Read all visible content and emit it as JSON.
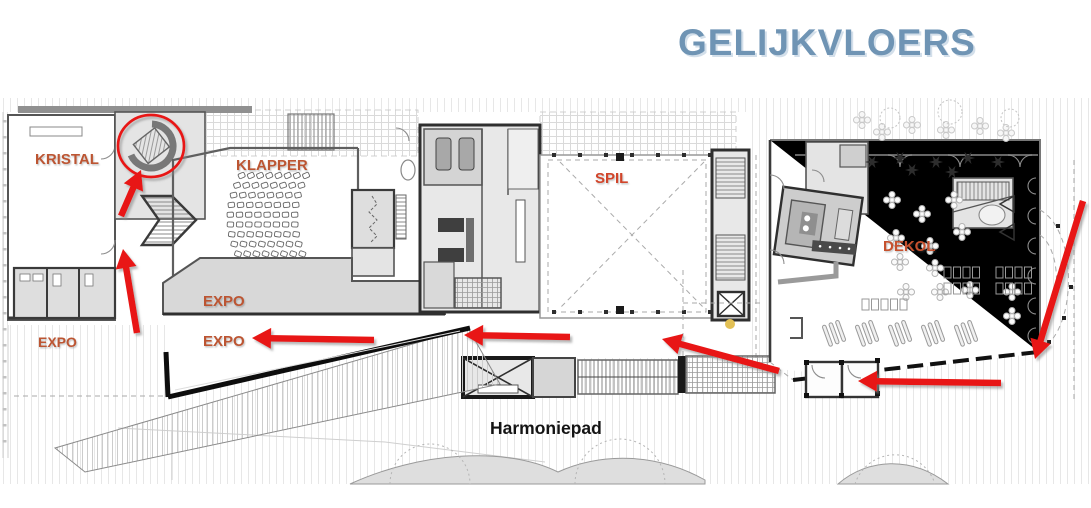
{
  "title": "GELIJKVLOERS",
  "colors": {
    "title": "#6f94b4",
    "room_label": "#bc5532",
    "route_arrow": "#e81812",
    "marker_dot": "#e2c055"
  },
  "floorplan": {
    "labels": {
      "kristal": "KRISTAL",
      "klapper": "KLAPPER",
      "spil": "SPIL",
      "dekol": "DEKOL",
      "expo_band": "EXPO",
      "expo_route": "EXPO",
      "expo_left": "EXPO",
      "path": "Harmoniepad"
    },
    "route": {
      "arrow_color": "#e81812",
      "arrows": [
        {
          "name": "to-spiral-stair",
          "from": [
            121,
            216
          ],
          "to": [
            141,
            170
          ]
        },
        {
          "name": "foyer-north",
          "from": [
            137,
            333
          ],
          "to": [
            123,
            249
          ]
        },
        {
          "name": "expo-west",
          "from": [
            374,
            340
          ],
          "to": [
            252,
            338
          ]
        },
        {
          "name": "corridor-west",
          "from": [
            570,
            337
          ],
          "to": [
            464,
            335
          ]
        },
        {
          "name": "passage-northwest",
          "from": [
            779,
            371
          ],
          "to": [
            662,
            339
          ]
        },
        {
          "name": "entrance-west",
          "from": [
            1001,
            383
          ],
          "to": [
            858,
            381
          ]
        },
        {
          "name": "dropoff-southwest",
          "from": [
            1083,
            201
          ],
          "to": [
            1035,
            359
          ]
        }
      ],
      "highlight_circle": {
        "cx": 151,
        "cy": 146,
        "rx": 33,
        "ry": 31
      },
      "marker_dot": {
        "cx": 730,
        "cy": 324,
        "r": 5
      }
    }
  }
}
